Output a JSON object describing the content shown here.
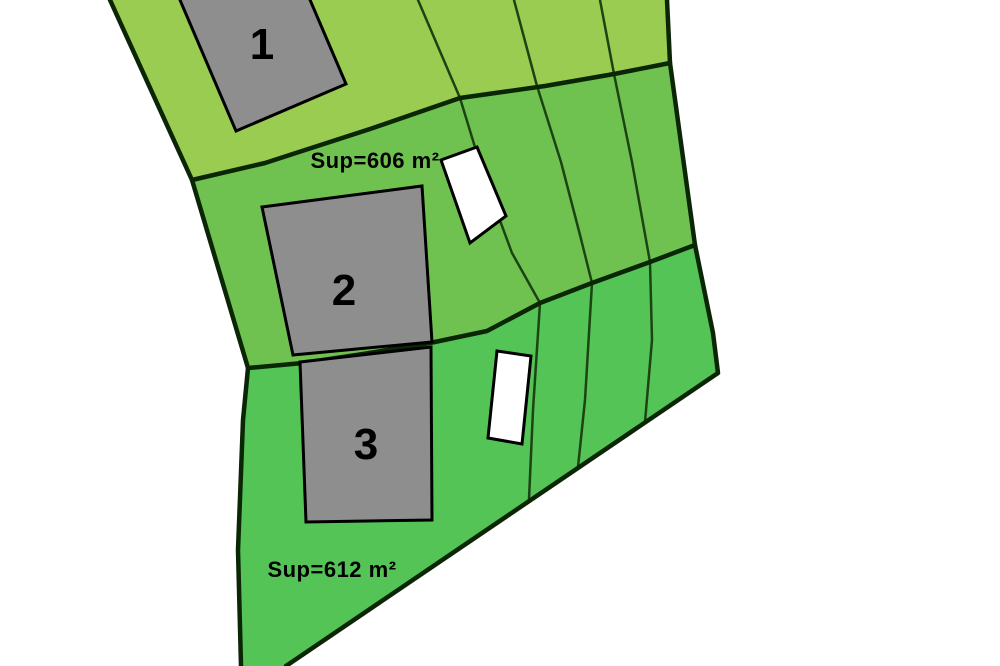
{
  "drawing": {
    "title": "parcel-subdivision-plan",
    "parcels": [
      {
        "name": "Parcel 1",
        "building_label": "1",
        "area_label": ""
      },
      {
        "name": "Parcel 2",
        "building_label": "2",
        "area_label": "Sup=606 m²"
      },
      {
        "name": "Parcel 3",
        "building_label": "3",
        "area_label": "Sup=612 m²"
      }
    ],
    "colors": {
      "parcel_1_fill": "#9acc52",
      "parcel_2_fill": "#6fc24f",
      "parcel_3_fill": "#53c455",
      "building_fill": "#8e8e8e",
      "annex_fill": "#ffffff",
      "boundary_line": "#0b2605",
      "lot_line": "#1c4413",
      "building_line": "#000000",
      "label_color": "#000000",
      "background": "#ffffff"
    }
  }
}
